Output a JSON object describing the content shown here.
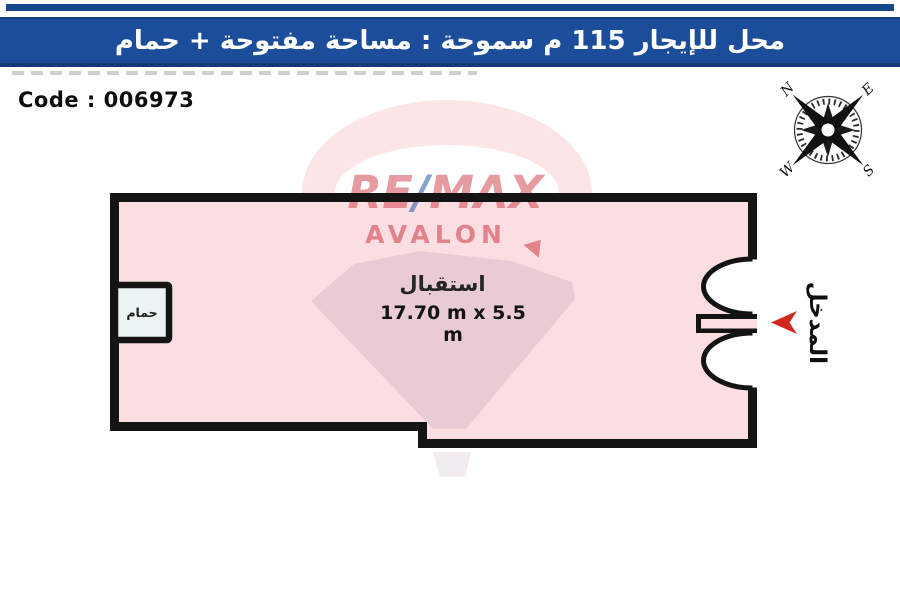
{
  "banner": {
    "title": "محل للإيجار 115 م سموحة : مساحة مفتوحة + حمام",
    "bg_color": "#1b4d9a",
    "edge_color": "#123a73"
  },
  "code": {
    "label": "Code : 006973"
  },
  "compass": {
    "n": "N",
    "e": "E",
    "s": "S",
    "w": "W"
  },
  "watermark": {
    "re": "RE",
    "slash": "/",
    "max": "MAX",
    "line2": "AVALON",
    "red_color": "rgba(206,55,66,0.55)",
    "blue_color": "rgba(32,84,166,0.55)"
  },
  "plan": {
    "room_label": "استقبال",
    "room_dimensions": "17.70 m x 5.5 m",
    "bathroom_label": "حمام",
    "entrance_label": "المدخل",
    "floor_color": "#fbdee2",
    "wall_color": "#141414",
    "bathroom_fill": "#e9f4f3",
    "arrow_color": "#d2291f"
  }
}
